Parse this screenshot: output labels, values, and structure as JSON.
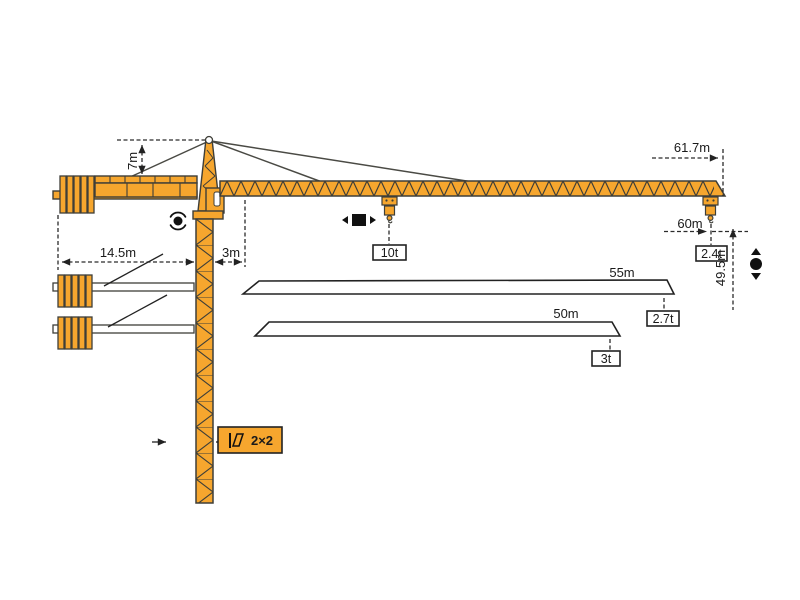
{
  "meta": {
    "type": "technical-diagram",
    "subject": "Tower crane working range and load diagram"
  },
  "colors": {
    "crane_orange": "#F6A62E",
    "outline": "#3E3E38",
    "dim_line": "#2B2B2B",
    "box_fill": "#FFFFFF"
  },
  "dimensions": {
    "apex_height": "7m",
    "counterjib_radius": "14.5m",
    "slew_offset": "3m",
    "max_radius": "61.7m",
    "tip_hook_radius": "60m",
    "hook_height": "49.5m",
    "tower_section": "2×2"
  },
  "loads": {
    "max_load": "10t",
    "tip_load_max_jib": "2.4t"
  },
  "jib_options": [
    {
      "length": "55m",
      "tip_load": "2.7t"
    },
    {
      "length": "50m",
      "tip_load": "3t"
    }
  ],
  "symbols": {
    "trolley_travel": "trolley travel direction",
    "slewing": "slewing rotation",
    "hoist": "hook up/down travel",
    "section": "tower cross-section"
  }
}
